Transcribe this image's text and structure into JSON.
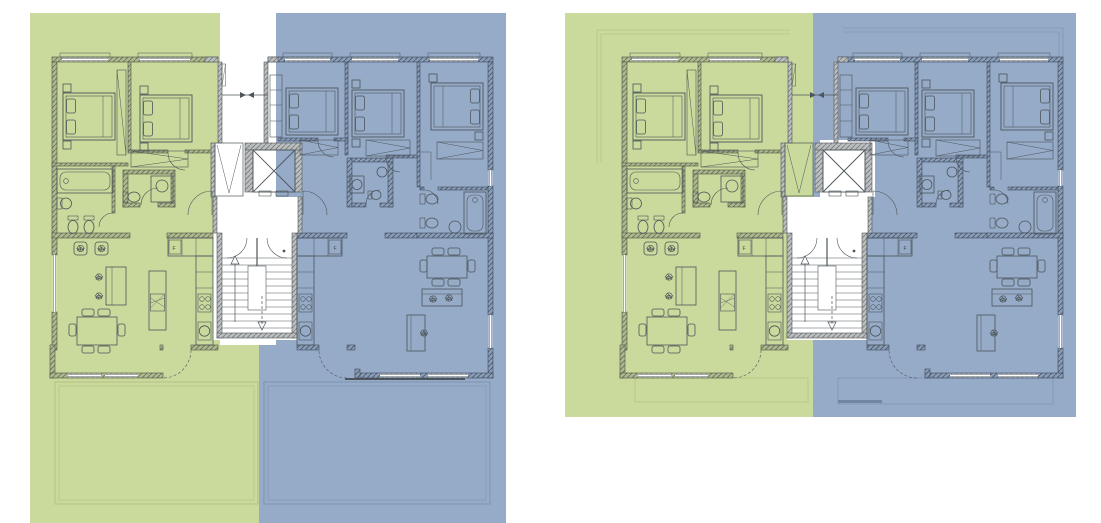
{
  "page": {
    "title": "Residential floor plans — two stacked-unit drawings"
  },
  "labels": {
    "fridge": "F"
  },
  "units": {
    "green": {
      "id": "unit-a",
      "overlay_color": "#c9dca3"
    },
    "blue": {
      "id": "unit-b",
      "overlay_color": "#98aec9"
    }
  },
  "panels": [
    {
      "id": "plan-left",
      "description": "floor plan with large lower terraces"
    },
    {
      "id": "plan-right",
      "description": "floor plan with upper roof-terrace outlines"
    }
  ],
  "colors": {
    "background": "#ffffff",
    "wall_hatch_gray": "#b9bcbd",
    "wall_hatch_olive": "#a9b38e",
    "wall_hatch_navy": "#8598b1",
    "linework": "#4d565a",
    "terrace_line": "#767b70"
  }
}
